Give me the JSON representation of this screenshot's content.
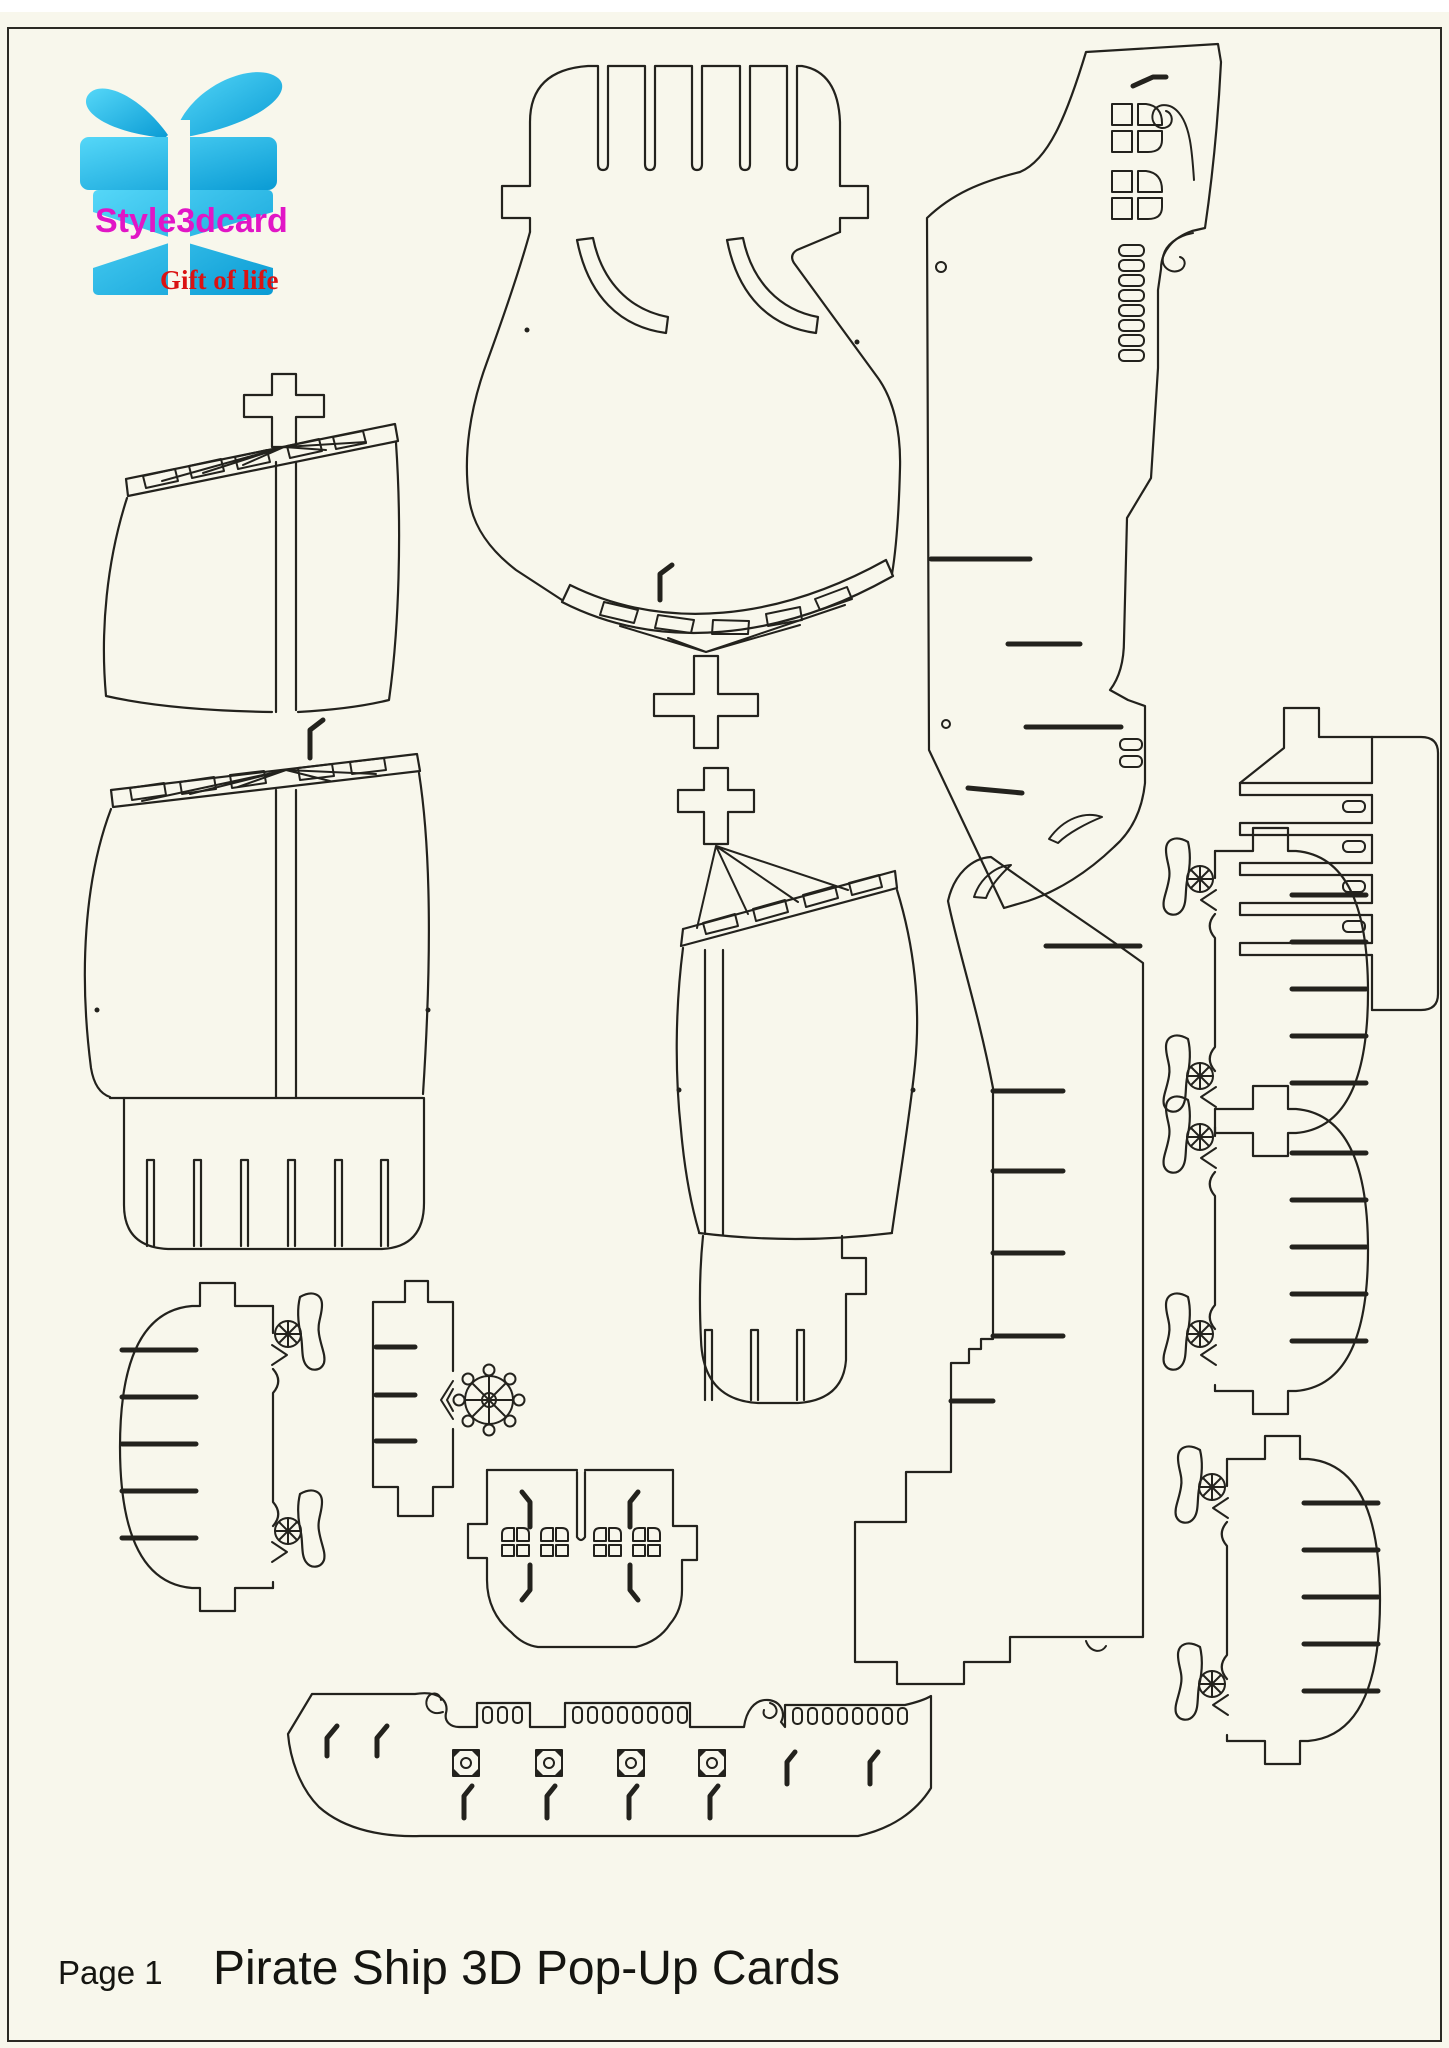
{
  "page": {
    "title": "Pirate Ship 3D Pop-Up Cards",
    "page_label": "Page 1",
    "background_color": "#f8f7ec",
    "line_color": "#23221d",
    "frame_color": "#2b2a24"
  },
  "logo": {
    "brand": "Style3dcard",
    "tagline": "Gift of life",
    "brand_color": "#e116c6",
    "tagline_color": "#da1212",
    "box_gradient_top": "#55d7f8",
    "box_gradient_bottom": "#0a9bd4",
    "icon": "gift-box-with-bow-icon"
  },
  "pieces": [
    {
      "id": "sail-assembly-left",
      "label": "Mast and sails piece (left, two sail sections with cross top, rigging fan, slotted yards, comb base)"
    },
    {
      "id": "sail-assembly-top",
      "label": "Mast and sail piece (top middle, inverted: comb top, hull body with curved slots, yard and cross at bottom)"
    },
    {
      "id": "sail-assembly-middle",
      "label": "Mast and sail piece (middle: cross top, rigging fan, slotted yard, sail body, slotted comb base)"
    },
    {
      "id": "card-base-top-right",
      "label": "Card base panel with stern cabin windows, scroll curls and ladder slots"
    },
    {
      "id": "card-base-center",
      "label": "Card mechanism panel with stair steps and long slots"
    },
    {
      "id": "slotted-comb-right",
      "label": "Slotted spar comb piece with tab and oval holes (top right)"
    },
    {
      "id": "deck-cannons-right-upper",
      "label": "Deck platform with cannon wheels and slots (right, upper)"
    },
    {
      "id": "deck-cannons-right-lower",
      "label": "Deck platform with cannon wheels and slots (right, lower)"
    },
    {
      "id": "deck-cannons-left",
      "label": "Deck platform with cannon wheels and slots (bottom left, mirrored)"
    },
    {
      "id": "mast-support-wheel",
      "label": "Mast support strip with ship's helm wheel"
    },
    {
      "id": "stern-cabin-windows",
      "label": "Stern cabin piece with four arched windows and bent slits"
    },
    {
      "id": "hull-side-railing",
      "label": "Ship hull side piece with scroll bow, slotted railing and gun-port decorations"
    }
  ]
}
